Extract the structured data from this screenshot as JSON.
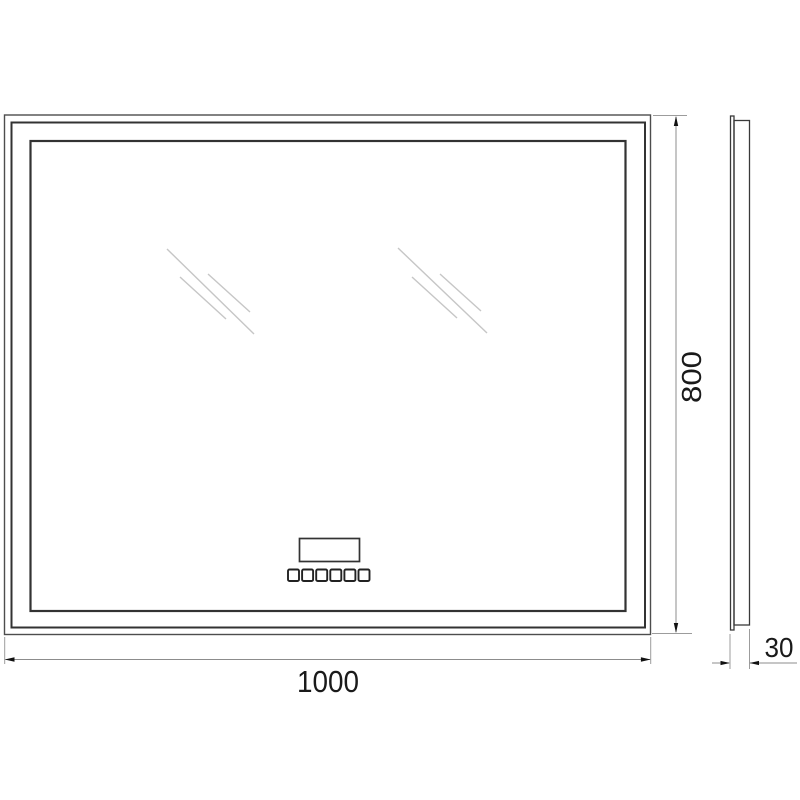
{
  "drawing": {
    "kind": "technical-dimension-drawing",
    "subject": "rectangular-led-mirror",
    "dimensions": {
      "width": {
        "label": "1000"
      },
      "height": {
        "label": "800"
      },
      "depth": {
        "label": "30"
      }
    },
    "controls": {
      "button_count": 6
    },
    "colors": {
      "frame_line": "#383838",
      "outer_line": "#4d4d4d",
      "dim_line": "#8c8c8c",
      "ext_line": "#9c9c9c",
      "arrow": "#111111",
      "reflection": "#c6c6c6",
      "text": "#1a1a1a",
      "background": "#ffffff"
    }
  }
}
